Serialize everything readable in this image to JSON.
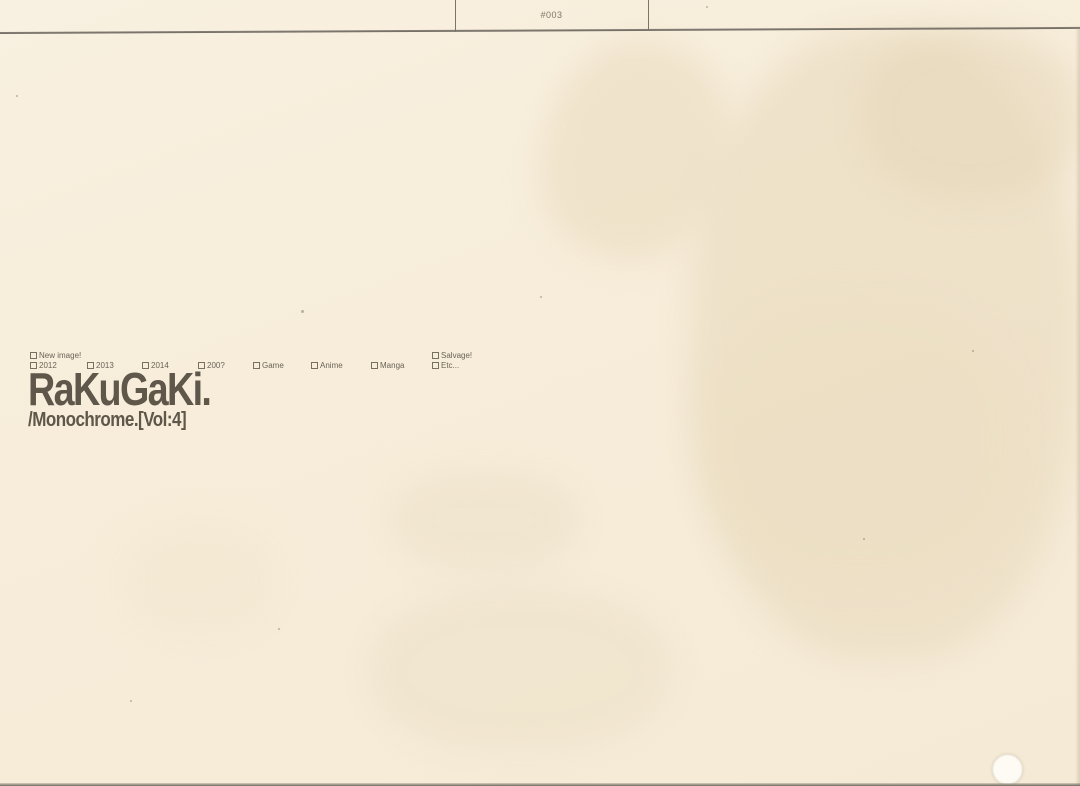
{
  "header": {
    "page_number": "#003"
  },
  "filters": {
    "row_top": [
      "New image!",
      "Salvage!"
    ],
    "row_bottom": [
      "2012",
      "2013",
      "2014",
      "200?",
      "Game",
      "Anime",
      "Manga",
      "Etc..."
    ]
  },
  "title": {
    "main": "RaKuGaKi.",
    "subtitle": "/Monochrome.[Vol:4]"
  },
  "colors": {
    "paper": "#f7edda",
    "ink": "#5e574a",
    "rule_line": "#6e6960",
    "small_text": "#6b6357"
  }
}
